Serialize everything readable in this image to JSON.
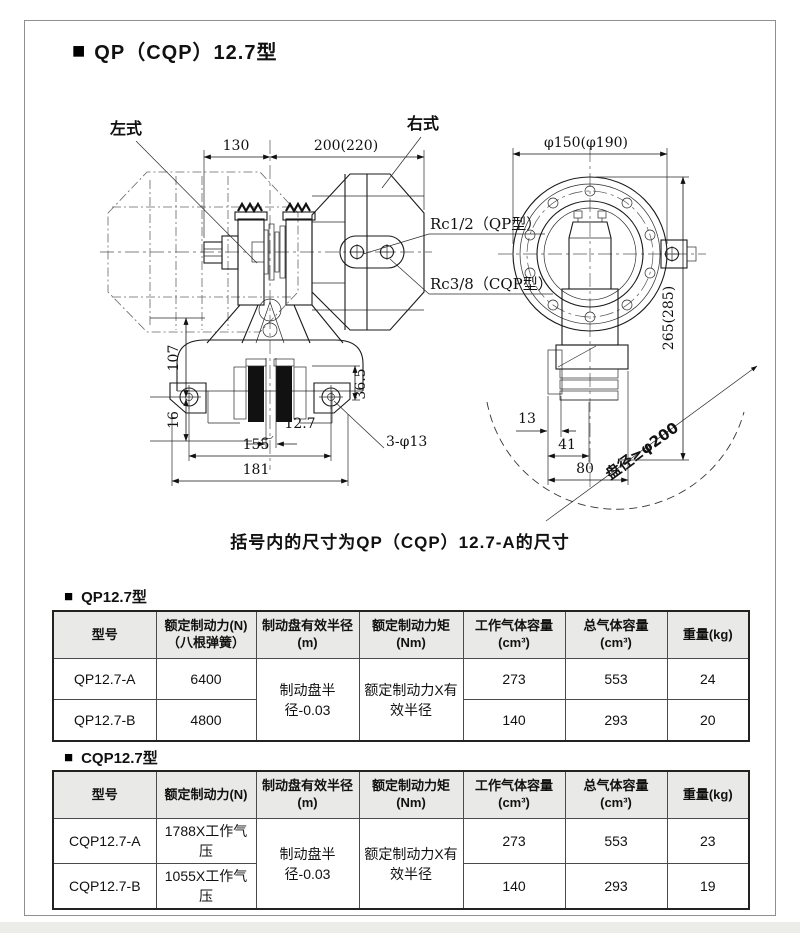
{
  "page": {
    "marker": "■",
    "title": "QP（CQP）12.7型",
    "caption": "括号内的尺寸为QP（CQP）12.7-A的尺寸"
  },
  "drawing": {
    "left_view_label": "左式",
    "right_view_label": "右式",
    "dim_shaft": "130",
    "dim_body": "200(220)",
    "port_qp": "Rc1/2（QP型）",
    "port_cqp": "Rc3/8（CQP型）",
    "dim_107": "107",
    "dim_16": "16",
    "dim_36_5": "36.5",
    "dim_12_7": "12.7",
    "dim_155": "155",
    "dim_181": "181",
    "dim_holes": "3-φ13",
    "dim_flange": "φ150(φ190)",
    "dim_height": "265(285)",
    "dim_13": "13",
    "dim_41": "41",
    "dim_80": "80",
    "disc_note": "盘径≥φ200"
  },
  "table_qp": {
    "heading": "QP12.7型",
    "headers": {
      "model": "型号",
      "force_1": "额定制动力(N)",
      "force_2": "（八根弹簧）",
      "radius_1": "制动盘有效半径",
      "radius_2": "(m)",
      "torque_1": "额定制动力矩",
      "torque_2": "(Nm)",
      "work_1": "工作气体容量",
      "work_2": "(cm³)",
      "total_1": "总气体容量",
      "total_2": "(cm³)",
      "weight": "重量(kg)"
    },
    "radius_value": "制动盘半径-0.03",
    "torque_value": "额定制动力X有效半径",
    "rows": [
      {
        "model": "QP12.7-A",
        "force": "6400",
        "work": "273",
        "total": "553",
        "weight": "24"
      },
      {
        "model": "QP12.7-B",
        "force": "4800",
        "work": "140",
        "total": "293",
        "weight": "20"
      }
    ]
  },
  "table_cqp": {
    "heading": "CQP12.7型",
    "headers": {
      "model": "型号",
      "force_1": "额定制动力(N)",
      "radius_1": "制动盘有效半径",
      "radius_2": "(m)",
      "torque_1": "额定制动力矩",
      "torque_2": "(Nm)",
      "work_1": "工作气体容量",
      "work_2": "(cm³)",
      "total_1": "总气体容量",
      "total_2": "(cm³)",
      "weight": "重量(kg)"
    },
    "radius_value": "制动盘半径-0.03",
    "torque_value": "额定制动力X有效半径",
    "rows": [
      {
        "model": "CQP12.7-A",
        "force": "1788X工作气压",
        "work": "273",
        "total": "553",
        "weight": "23"
      },
      {
        "model": "CQP12.7-B",
        "force": "1055X工作气压",
        "work": "140",
        "total": "293",
        "weight": "19"
      }
    ]
  }
}
